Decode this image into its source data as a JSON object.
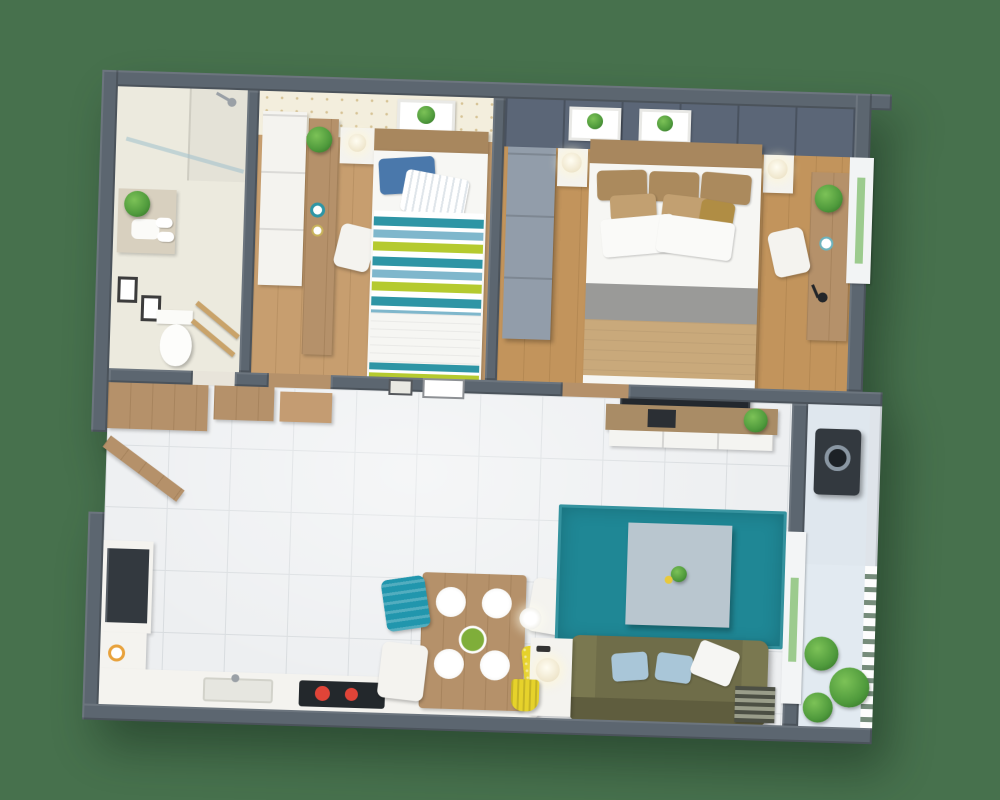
{
  "scene": {
    "type": "3d-floor-plan-render",
    "view": "top-down isometric",
    "description": "3D rendered floor plan of a one-bedroom apartment with kids room, master bedroom, bathroom, entry hall, open kitchen-living-dining room and balcony",
    "visible_text": ""
  },
  "colors": {
    "background": "#47714d",
    "wall": "#5c6670",
    "wall_dark": "#4a535c",
    "tile_floor": "#edeff1",
    "tile_line": "#d8dcdf",
    "bath_floor": "#eceade",
    "wood_floor_1": "#c79e6f",
    "wood_floor_2": "#c2945c",
    "wood_furniture": "#b5916a",
    "wood_dark": "#a8875e",
    "wallpaper": "#f3eedd",
    "accent_wall": "#5b6677",
    "wardrobe_gray": "#929daa",
    "white_furniture": "#f4f3ef",
    "rug": "#1f8795",
    "coffee_table": "#b9c6cf",
    "sofa": "#6f6d49",
    "sofa_dark": "#5f5d3e",
    "sofa_arm": "#7a7850",
    "pillow_blue": "#a9c6d8",
    "bed1_blue": "#4a78ab",
    "stripe_teal": "#2e95a5",
    "stripe_blue": "#7fb7cc",
    "stripe_lime": "#b5ca2f",
    "bed2_pillow": "#ab8a5d",
    "bed2_pillow_light": "#c2a071",
    "bed2_gold": "#b08d44",
    "bed2_blanket": "#c9a97b",
    "throw_gray": "#9a9a98",
    "chair_teal": "#2196ad",
    "chair_yellow": "#e6d22b",
    "burner_red": "#e04438",
    "appliance_dark": "#33393f",
    "plant_green": "#4f9a3c",
    "balcony_floor": "#e2eaf1",
    "nook_floor": "#dfe7ee",
    "glass_green": "#9ccb8e"
  },
  "rooms": [
    {
      "id": "bathroom",
      "furniture": [
        "shower with glass partition",
        "shower tray",
        "vanity shelf with plant",
        "rolled towels",
        "two wall picture frames",
        "toilet",
        "wooden towel ladder"
      ]
    },
    {
      "id": "kids-bedroom",
      "furniture": [
        "white wardrobe",
        "wooden desk with plant and decor plates",
        "white desk chair",
        "white nightstand with lamp",
        "single bed with blue pillow, striped white pillow and teal-blue-lime striped duvet",
        "botanical wall art",
        "dotted wallpaper accent wall"
      ]
    },
    {
      "id": "master-bedroom",
      "furniture": [
        "slate accent headboard wall with two botanical prints",
        "gray wardrobe",
        "double bed with tan and white pillows, gray throw and tan blanket",
        "two white nightstands with lamps",
        "wooden desk with plant, cup and black lamp",
        "white chair",
        "window"
      ]
    },
    {
      "id": "entry-hall",
      "furniture": [
        "wooden wardrobe",
        "open wooden front door"
      ]
    },
    {
      "id": "kitchen",
      "furniture": [
        "wooden upper cabinets",
        "tall unit with dark oven-fridge",
        "left counter with sink and breakfast plates",
        "bottom counter with inset sink",
        "dark cooktop with red burners"
      ]
    },
    {
      "id": "dining",
      "furniture": [
        "wooden dining table",
        "four white place settings",
        "green salad bowl",
        "teal chair",
        "two white chairs",
        "yellow chair"
      ]
    },
    {
      "id": "living-room",
      "furniture": [
        "wall TV",
        "wooden media console with plant and decor",
        "teal rug",
        "gray coffee table with small plant",
        "olive sofa with light blue and white pillows",
        "white side table with lamp",
        "white floor lamp",
        "yellow basket",
        "striped floor mat",
        "balcony door"
      ]
    },
    {
      "id": "laundry-nook",
      "furniture": [
        "washing machine"
      ]
    },
    {
      "id": "balcony",
      "furniture": [
        "white railing",
        "green plants"
      ]
    }
  ]
}
